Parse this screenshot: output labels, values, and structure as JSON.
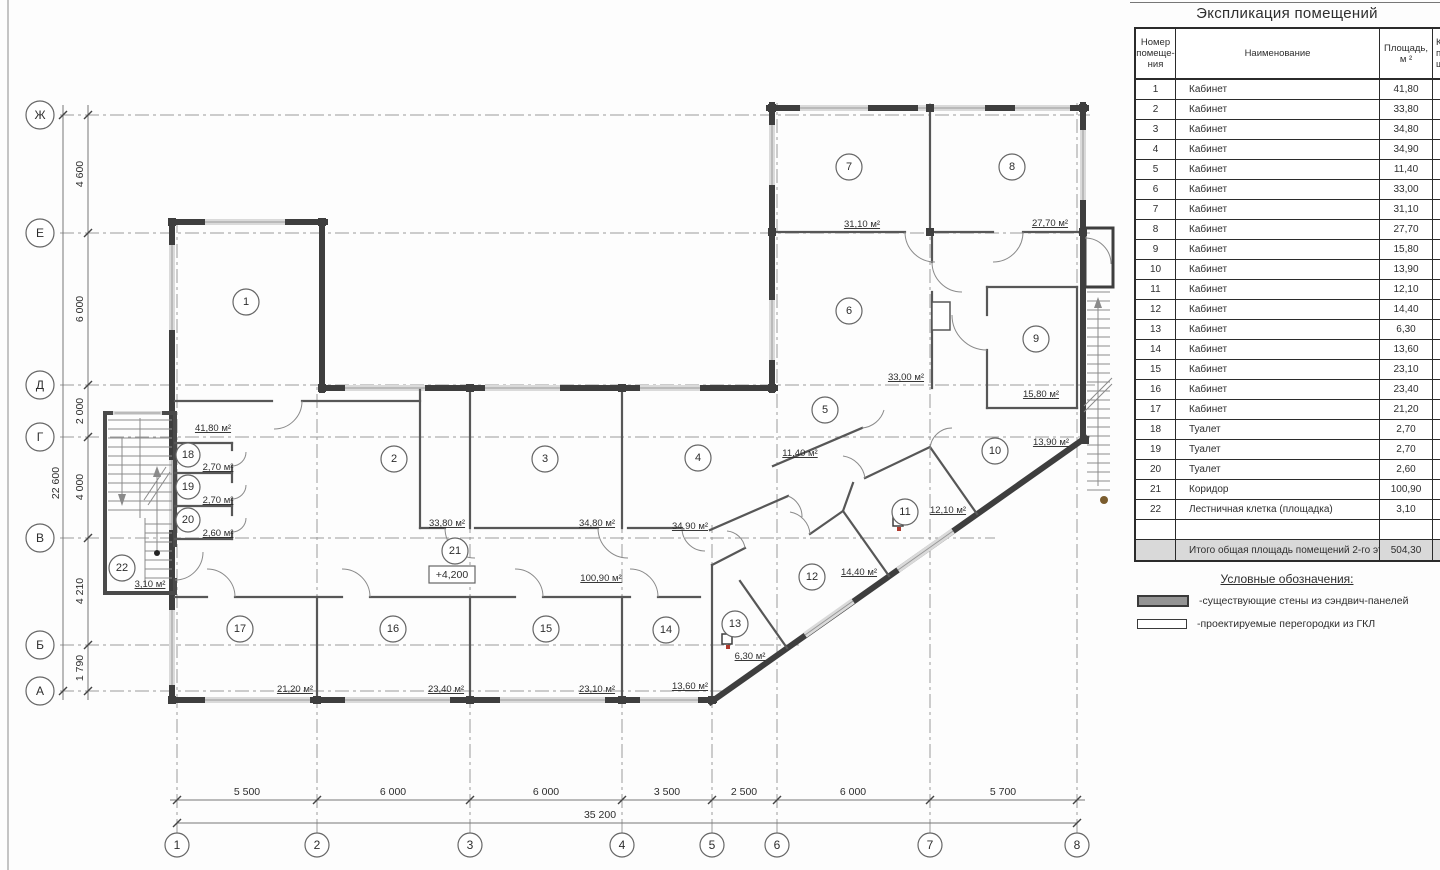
{
  "table": {
    "title": "Экспликация помещений",
    "col1": [
      "Номер",
      "помеще-",
      "ния"
    ],
    "col2": "Наименование",
    "col3": [
      "Площадь,",
      "м ²"
    ],
    "col4": [
      "Ка",
      "пом",
      "ще"
    ],
    "rows": [
      {
        "n": "1",
        "name": "Кабинет",
        "area": "41,80"
      },
      {
        "n": "2",
        "name": "Кабинет",
        "area": "33,80"
      },
      {
        "n": "3",
        "name": "Кабинет",
        "area": "34,80"
      },
      {
        "n": "4",
        "name": "Кабинет",
        "area": "34,90"
      },
      {
        "n": "5",
        "name": "Кабинет",
        "area": "11,40"
      },
      {
        "n": "6",
        "name": "Кабинет",
        "area": "33,00"
      },
      {
        "n": "7",
        "name": "Кабинет",
        "area": "31,10"
      },
      {
        "n": "8",
        "name": "Кабинет",
        "area": "27,70"
      },
      {
        "n": "9",
        "name": "Кабинет",
        "area": "15,80"
      },
      {
        "n": "10",
        "name": "Кабинет",
        "area": "13,90"
      },
      {
        "n": "11",
        "name": "Кабинет",
        "area": "12,10"
      },
      {
        "n": "12",
        "name": "Кабинет",
        "area": "14,40"
      },
      {
        "n": "13",
        "name": "Кабинет",
        "area": "6,30"
      },
      {
        "n": "14",
        "name": "Кабинет",
        "area": "13,60"
      },
      {
        "n": "15",
        "name": "Кабинет",
        "area": "23,10"
      },
      {
        "n": "16",
        "name": "Кабинет",
        "area": "23,40"
      },
      {
        "n": "17",
        "name": "Кабинет",
        "area": "21,20"
      },
      {
        "n": "18",
        "name": "Туалет",
        "area": "2,70"
      },
      {
        "n": "19",
        "name": "Туалет",
        "area": "2,70"
      },
      {
        "n": "20",
        "name": "Туалет",
        "area": "2,60"
      },
      {
        "n": "21",
        "name": "Коридор",
        "area": "100,90"
      },
      {
        "n": "22",
        "name": "Лестничная клетка (площадка)",
        "area": "3,10"
      }
    ],
    "total_label": "Итого общая площадь помещений 2-го этажа:",
    "total_value": "504,30"
  },
  "legend": {
    "title": "Условные обозначения:",
    "items": [
      {
        "swatch": "existing-sandwich-wall",
        "label": "-существующие стены из сэндвич-панелей"
      },
      {
        "swatch": "designed-gkl-partition",
        "label": "-проектируемые перегородки из ГКЛ"
      }
    ]
  },
  "plan": {
    "elevation": "+4,200",
    "rooms": [
      {
        "n": "1",
        "area": "41,80 м²"
      },
      {
        "n": "2",
        "area": "33,80 м²"
      },
      {
        "n": "3",
        "area": "34,80 м²"
      },
      {
        "n": "4",
        "area": "34,90 м²"
      },
      {
        "n": "5",
        "area": "11,40 м²"
      },
      {
        "n": "6",
        "area": "33,00 м²"
      },
      {
        "n": "7",
        "area": "31,10 м²"
      },
      {
        "n": "8",
        "area": "27,70 м²"
      },
      {
        "n": "9",
        "area": "15,80 м²"
      },
      {
        "n": "10",
        "area": "13,90 м²"
      },
      {
        "n": "11",
        "area": "12,10 м²"
      },
      {
        "n": "12",
        "area": "14,40 м²"
      },
      {
        "n": "13",
        "area": "6,30 м²"
      },
      {
        "n": "14",
        "area": "13,60 м²"
      },
      {
        "n": "15",
        "area": "23,10 м²"
      },
      {
        "n": "16",
        "area": "23,40 м²"
      },
      {
        "n": "17",
        "area": "21,20 м²"
      },
      {
        "n": "18",
        "area": "2,70 м²"
      },
      {
        "n": "19",
        "area": "2,70 м²"
      },
      {
        "n": "20",
        "area": "2,60 м²"
      },
      {
        "n": "21",
        "area": "100,90 м²"
      },
      {
        "n": "22",
        "area": "3,10 м²"
      }
    ],
    "axis_rows": [
      "Ж",
      "Е",
      "Д",
      "Г",
      "В",
      "Б",
      "А"
    ],
    "axis_cols": [
      "1",
      "2",
      "3",
      "4",
      "5",
      "6",
      "7",
      "8"
    ],
    "dims_v": [
      "4 600",
      "6 000",
      "2 000",
      "4 000",
      "4 210",
      "1 790"
    ],
    "dim_v_total": "22 600",
    "dims_h": [
      "5 500",
      "6 000",
      "6 000",
      "3 500",
      "2 500",
      "6 000",
      "5 700"
    ],
    "dim_h_total": "35 200"
  }
}
